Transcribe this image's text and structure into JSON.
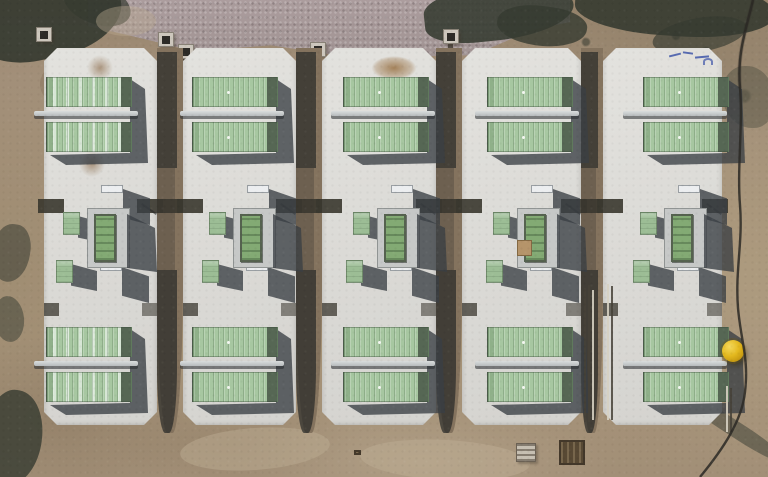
{
  "scene": {
    "type": "aerial-photo",
    "description": "Top-down drone photo of a battery energy storage site: five parallel light-concrete pads on bare tan dirt, each pad holding two pairs of sage-green storage containers with a light rail between each pair, central transformer and cabinet equipment, a gravel strip and dark tree shadows along the top, a black cable along the right edge and a yellow dome marker beside the rightmost pad.",
    "colors": {
      "dirtBase": "#a3907a",
      "dirtLight": "#bcab92",
      "dirtDark": "#84715a",
      "gravel": "#a5989a",
      "tree": "#363b31",
      "pad": "#deddda",
      "green": "#a7c7a1",
      "greenDark": "#8fb089",
      "greenEnd": "#566754",
      "gboxGreen": "#9cbd95",
      "txGreen": "#83aa74",
      "cab": "#eceef0",
      "shadow": "rgba(58,63,68,0.78)",
      "trench": "#3a372f",
      "gapDirt": "#84735e",
      "yellow": "#e3b81e",
      "cable": "#2c2924"
    },
    "site": {
      "pad_count": 5,
      "containers_per_pad": 4,
      "pad_top": 48,
      "pad_height": 377,
      "pads": [
        {
          "name": "pad-1",
          "x": 44,
          "width": 113,
          "container_offset": 2,
          "mid_offset": -7,
          "roof_style": "streaked",
          "stains": [
            [
              48,
              116
            ],
            [
              56,
              20
            ]
          ]
        },
        {
          "name": "pad-2",
          "x": 183,
          "width": 113,
          "container_offset": 9,
          "mid_offset": 0
        },
        {
          "name": "pad-3",
          "x": 322,
          "width": 114,
          "container_offset": 21,
          "mid_offset": 5,
          "stain_big": true
        },
        {
          "name": "pad-4",
          "x": 462,
          "width": 119,
          "container_offset": 25,
          "mid_offset": 5,
          "board": true
        },
        {
          "name": "pad-5",
          "x": 603,
          "width": 119,
          "container_offset": 40,
          "mid_offset": 11,
          "rail_shift": -8,
          "graffiti": true
        }
      ]
    },
    "objects": {
      "yellow_dome": {
        "x": 722,
        "y": 340,
        "d": 22
      },
      "junction_boxes": [
        {
          "x": 36,
          "y": 27
        },
        {
          "x": 158,
          "y": 32
        },
        {
          "x": 178,
          "y": 44,
          "trench_to": 150
        },
        {
          "x": 310,
          "y": 42,
          "trench_to": 150
        },
        {
          "x": 443,
          "y": 29,
          "trench_to": 148
        }
      ],
      "rebar_rods": [
        {
          "x": 584,
          "y": 288,
          "h": 134,
          "tone": "dark"
        },
        {
          "x": 588,
          "y": 285,
          "h": 137,
          "tone": "dark"
        },
        {
          "x": 592,
          "y": 290,
          "h": 130,
          "tone": "light"
        },
        {
          "x": 607,
          "y": 284,
          "h": 136,
          "tone": "light"
        },
        {
          "x": 611,
          "y": 286,
          "h": 134,
          "tone": "dark"
        },
        {
          "x": 726,
          "y": 386,
          "h": 46,
          "tone": "light"
        },
        {
          "x": 730,
          "y": 388,
          "h": 44,
          "tone": "dark"
        }
      ],
      "ground_pallets": [
        {
          "x": 516,
          "y": 443,
          "w": 20,
          "h": 19,
          "tone": "light"
        },
        {
          "x": 559,
          "y": 440,
          "w": 26,
          "h": 25,
          "tone": "dark"
        },
        {
          "x": 354,
          "y": 450,
          "w": 7,
          "h": 5,
          "tone": "dark"
        }
      ],
      "graffiti_note": "illegible blue spray markings on pad-5"
    },
    "ground_features": [
      {
        "n": "tree-shadow",
        "x": -28,
        "y": -30,
        "w": 150,
        "h": 88,
        "rot": -12,
        "c": "tree",
        "o": 0.92,
        "r": "40% 60% 55% 45%"
      },
      {
        "n": "tree-shadow",
        "x": 62,
        "y": -16,
        "w": 70,
        "h": 40,
        "rot": 20,
        "c": "tree",
        "o": 0.7,
        "r": "50%"
      },
      {
        "n": "tree-shadow",
        "x": 424,
        "y": -14,
        "w": 150,
        "h": 54,
        "rot": -6,
        "c": "tree",
        "o": 0.88,
        "r": "45% 55% 60% 40%"
      },
      {
        "n": "tree-shadow",
        "x": 497,
        "y": 6,
        "w": 90,
        "h": 40,
        "rot": 8,
        "c": "tree",
        "o": 0.8,
        "r": "50% 40% 55% 45%"
      },
      {
        "n": "tree-shadow",
        "x": 575,
        "y": -22,
        "w": 200,
        "h": 58,
        "rot": 4,
        "c": "tree",
        "o": 0.9,
        "r": "40% 55% 50% 45%"
      },
      {
        "n": "tree-shadow",
        "x": 652,
        "y": 18,
        "w": 95,
        "h": 34,
        "rot": -10,
        "c": "tree",
        "o": 0.65,
        "r": "50%"
      },
      {
        "n": "tree-shadow",
        "x": 722,
        "y": 66,
        "w": 52,
        "h": 62,
        "rot": 0,
        "c": "tree",
        "o": 0.35,
        "r": "45% 55% 40% 60%"
      },
      {
        "n": "brush-shadow",
        "x": -8,
        "y": 224,
        "w": 38,
        "h": 58,
        "rot": 8,
        "c": "tree",
        "o": 0.55,
        "r": "50% 45% 55% 50%"
      },
      {
        "n": "brush-shadow",
        "x": -6,
        "y": 296,
        "w": 30,
        "h": 46,
        "rot": -6,
        "c": "tree",
        "o": 0.5,
        "r": "50%"
      },
      {
        "n": "tree-shadow",
        "x": -16,
        "y": 390,
        "w": 58,
        "h": 95,
        "rot": 10,
        "c": "tree",
        "o": 0.8,
        "r": "45% 55% 50% 40%"
      },
      {
        "n": "shadow-streak",
        "x": 676,
        "y": 420,
        "w": 115,
        "h": 16,
        "rot": 33,
        "c": "tree",
        "o": 0.5,
        "r": "40%"
      },
      {
        "n": "dirt-patch-light",
        "x": 180,
        "y": 428,
        "w": 150,
        "h": 42,
        "rot": -4,
        "c": "dirtLight",
        "o": 0.5,
        "r": "50%"
      },
      {
        "n": "dirt-patch-light",
        "x": 360,
        "y": 440,
        "w": 170,
        "h": 40,
        "rot": 3,
        "c": "dirtLight",
        "o": 0.55,
        "r": "50%"
      },
      {
        "n": "dirt-patch-light",
        "x": 96,
        "y": 6,
        "w": 60,
        "h": 30,
        "rot": 0,
        "c": "dirtLight",
        "o": 0.4,
        "r": "50%"
      },
      {
        "n": "dirt-patch-dark",
        "x": 40,
        "y": 58,
        "w": 70,
        "h": 52,
        "rot": 0,
        "c": "dirtDark",
        "o": 0.45,
        "r": "50%"
      },
      {
        "n": "dirt-patch-dark",
        "x": 585,
        "y": 55,
        "w": 120,
        "h": 42,
        "rot": 5,
        "c": "dirtDark",
        "o": 0.4,
        "r": "50%"
      }
    ]
  }
}
